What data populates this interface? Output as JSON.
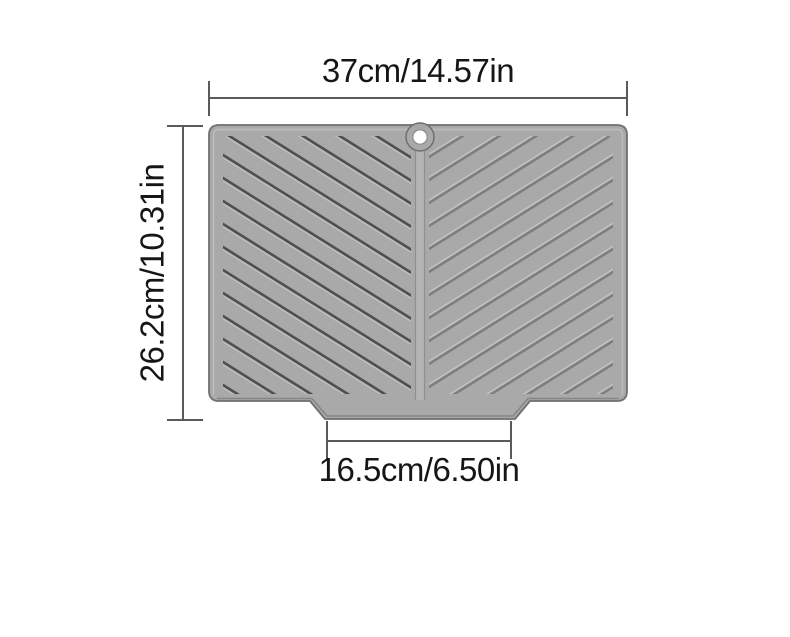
{
  "labels": {
    "top": "37cm/14.57in",
    "left": "26.2cm/10.31in",
    "bottom": "16.5cm/6.50in"
  },
  "icons": {
    "hang_hole": "hang-hole"
  },
  "colors": {
    "background": "#ffffff",
    "text": "#161616",
    "dimension_line": "#5a5a5a",
    "mat_face": "#a9a9a9",
    "mat_edge": "#6f6f6f",
    "mat_bevel_light": "#c0c0c0",
    "mat_bevel_dark": "#818181",
    "groove_dark": "#4f4f4f",
    "groove_mid": "#7e7e7e",
    "groove_highlight": "#c4c4c4",
    "ridge_fill": "#b4b4b4",
    "ridge_edge": "#8e8e8e",
    "hole_fill": "#ffffff",
    "hole_ring": "#8a8a8a"
  }
}
